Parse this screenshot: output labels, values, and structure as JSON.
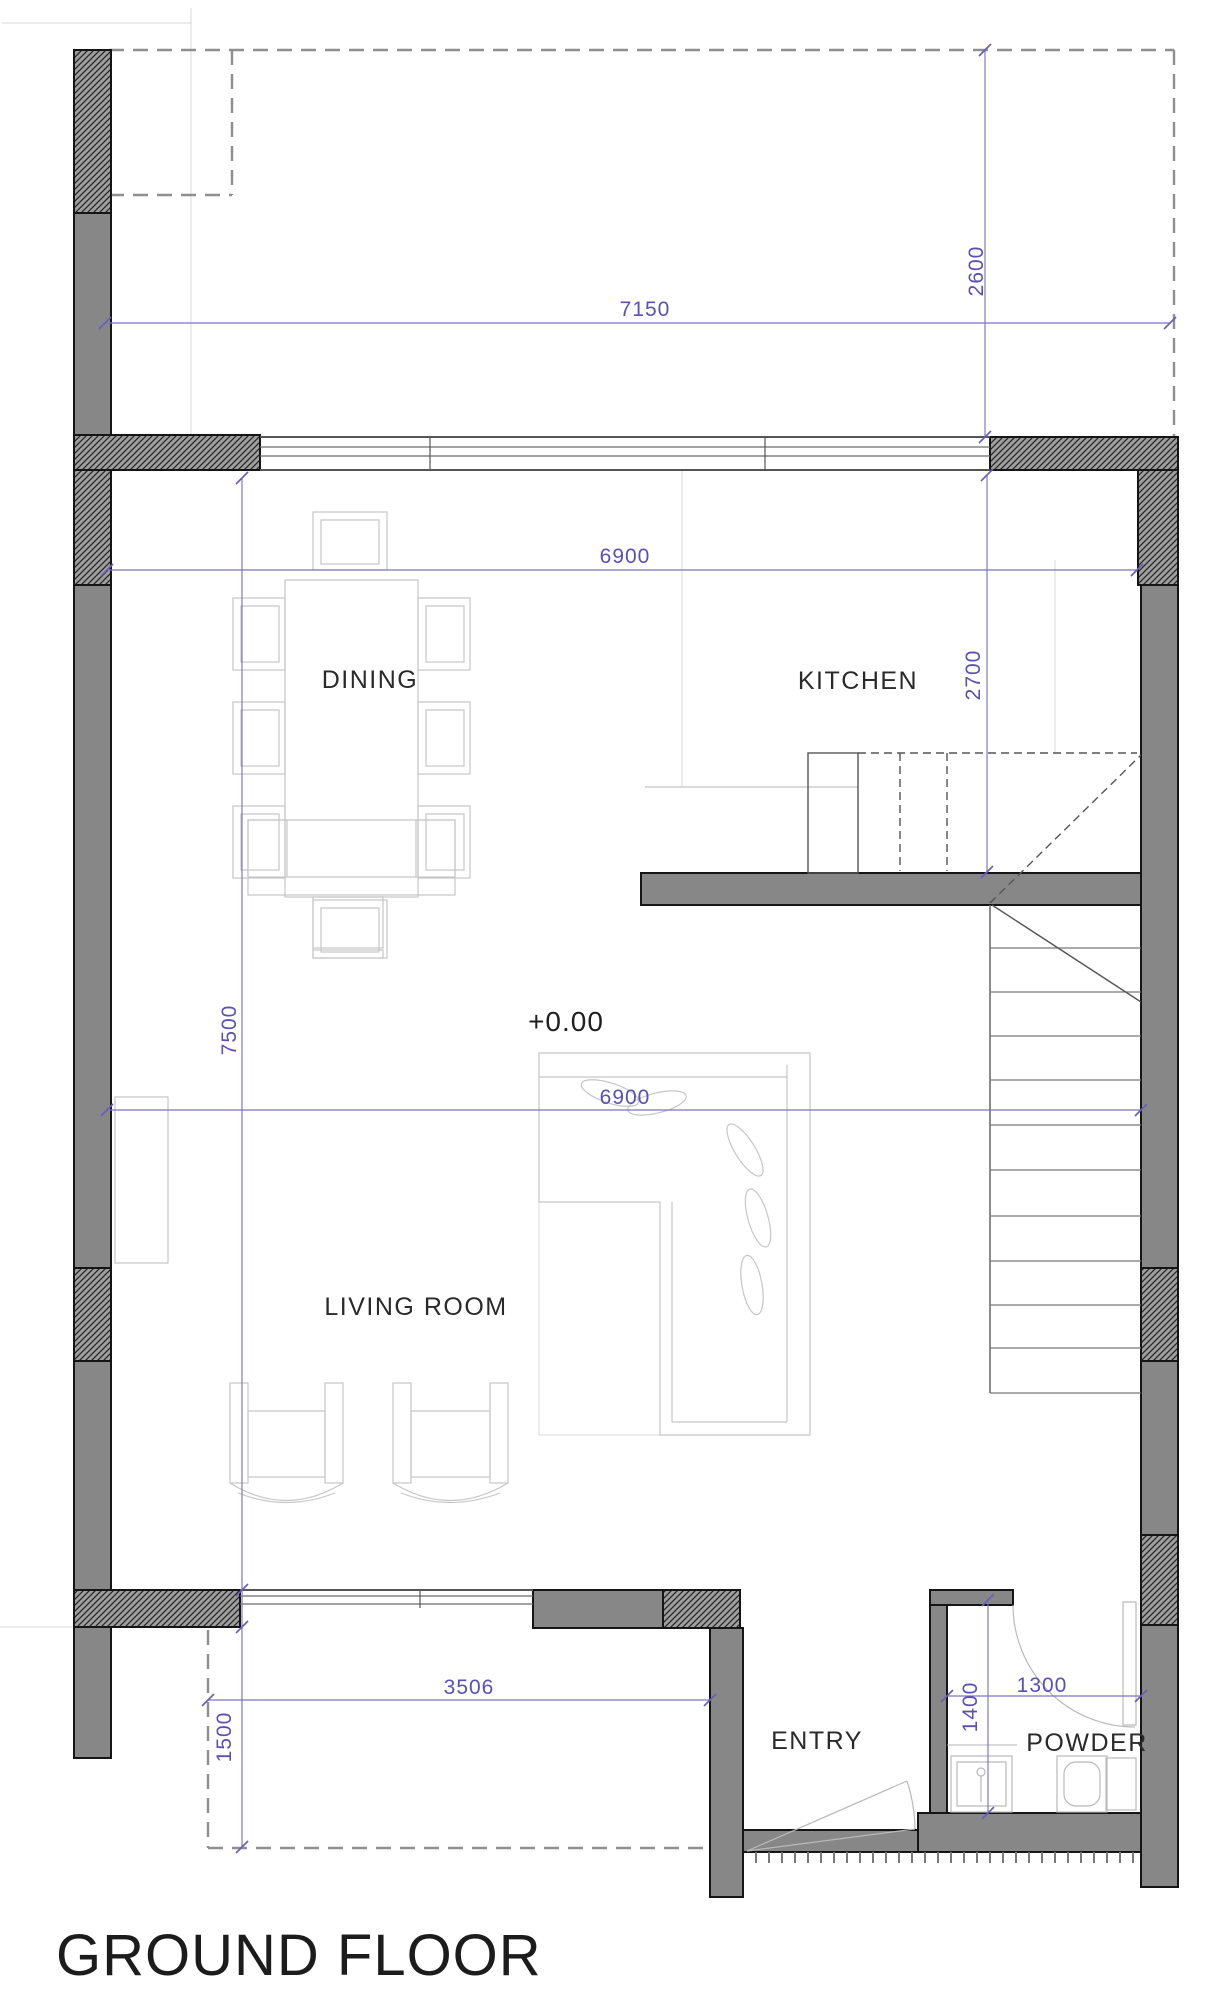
{
  "title": "GROUND FLOOR",
  "level_marker": "+0.00",
  "rooms": {
    "dining": "DINING",
    "kitchen": "KITCHEN",
    "living": "LIVING ROOM",
    "entry": "ENTRY",
    "powder": "POWDER"
  },
  "dimensions": {
    "top_width": "7150",
    "top_right_height": "2600",
    "upper_width": "6900",
    "kitchen_height": "2700",
    "left_height": "7500",
    "mid_width": "6900",
    "bottom_width": "3506",
    "porch_depth": "1500",
    "powder_height": "1400",
    "powder_width": "1300"
  },
  "colors": {
    "wall_fill": "#878787",
    "wall_edge": "#151515",
    "dimension": "#6a5fb8",
    "furniture": "#c6c6c6",
    "background": "#ffffff"
  }
}
